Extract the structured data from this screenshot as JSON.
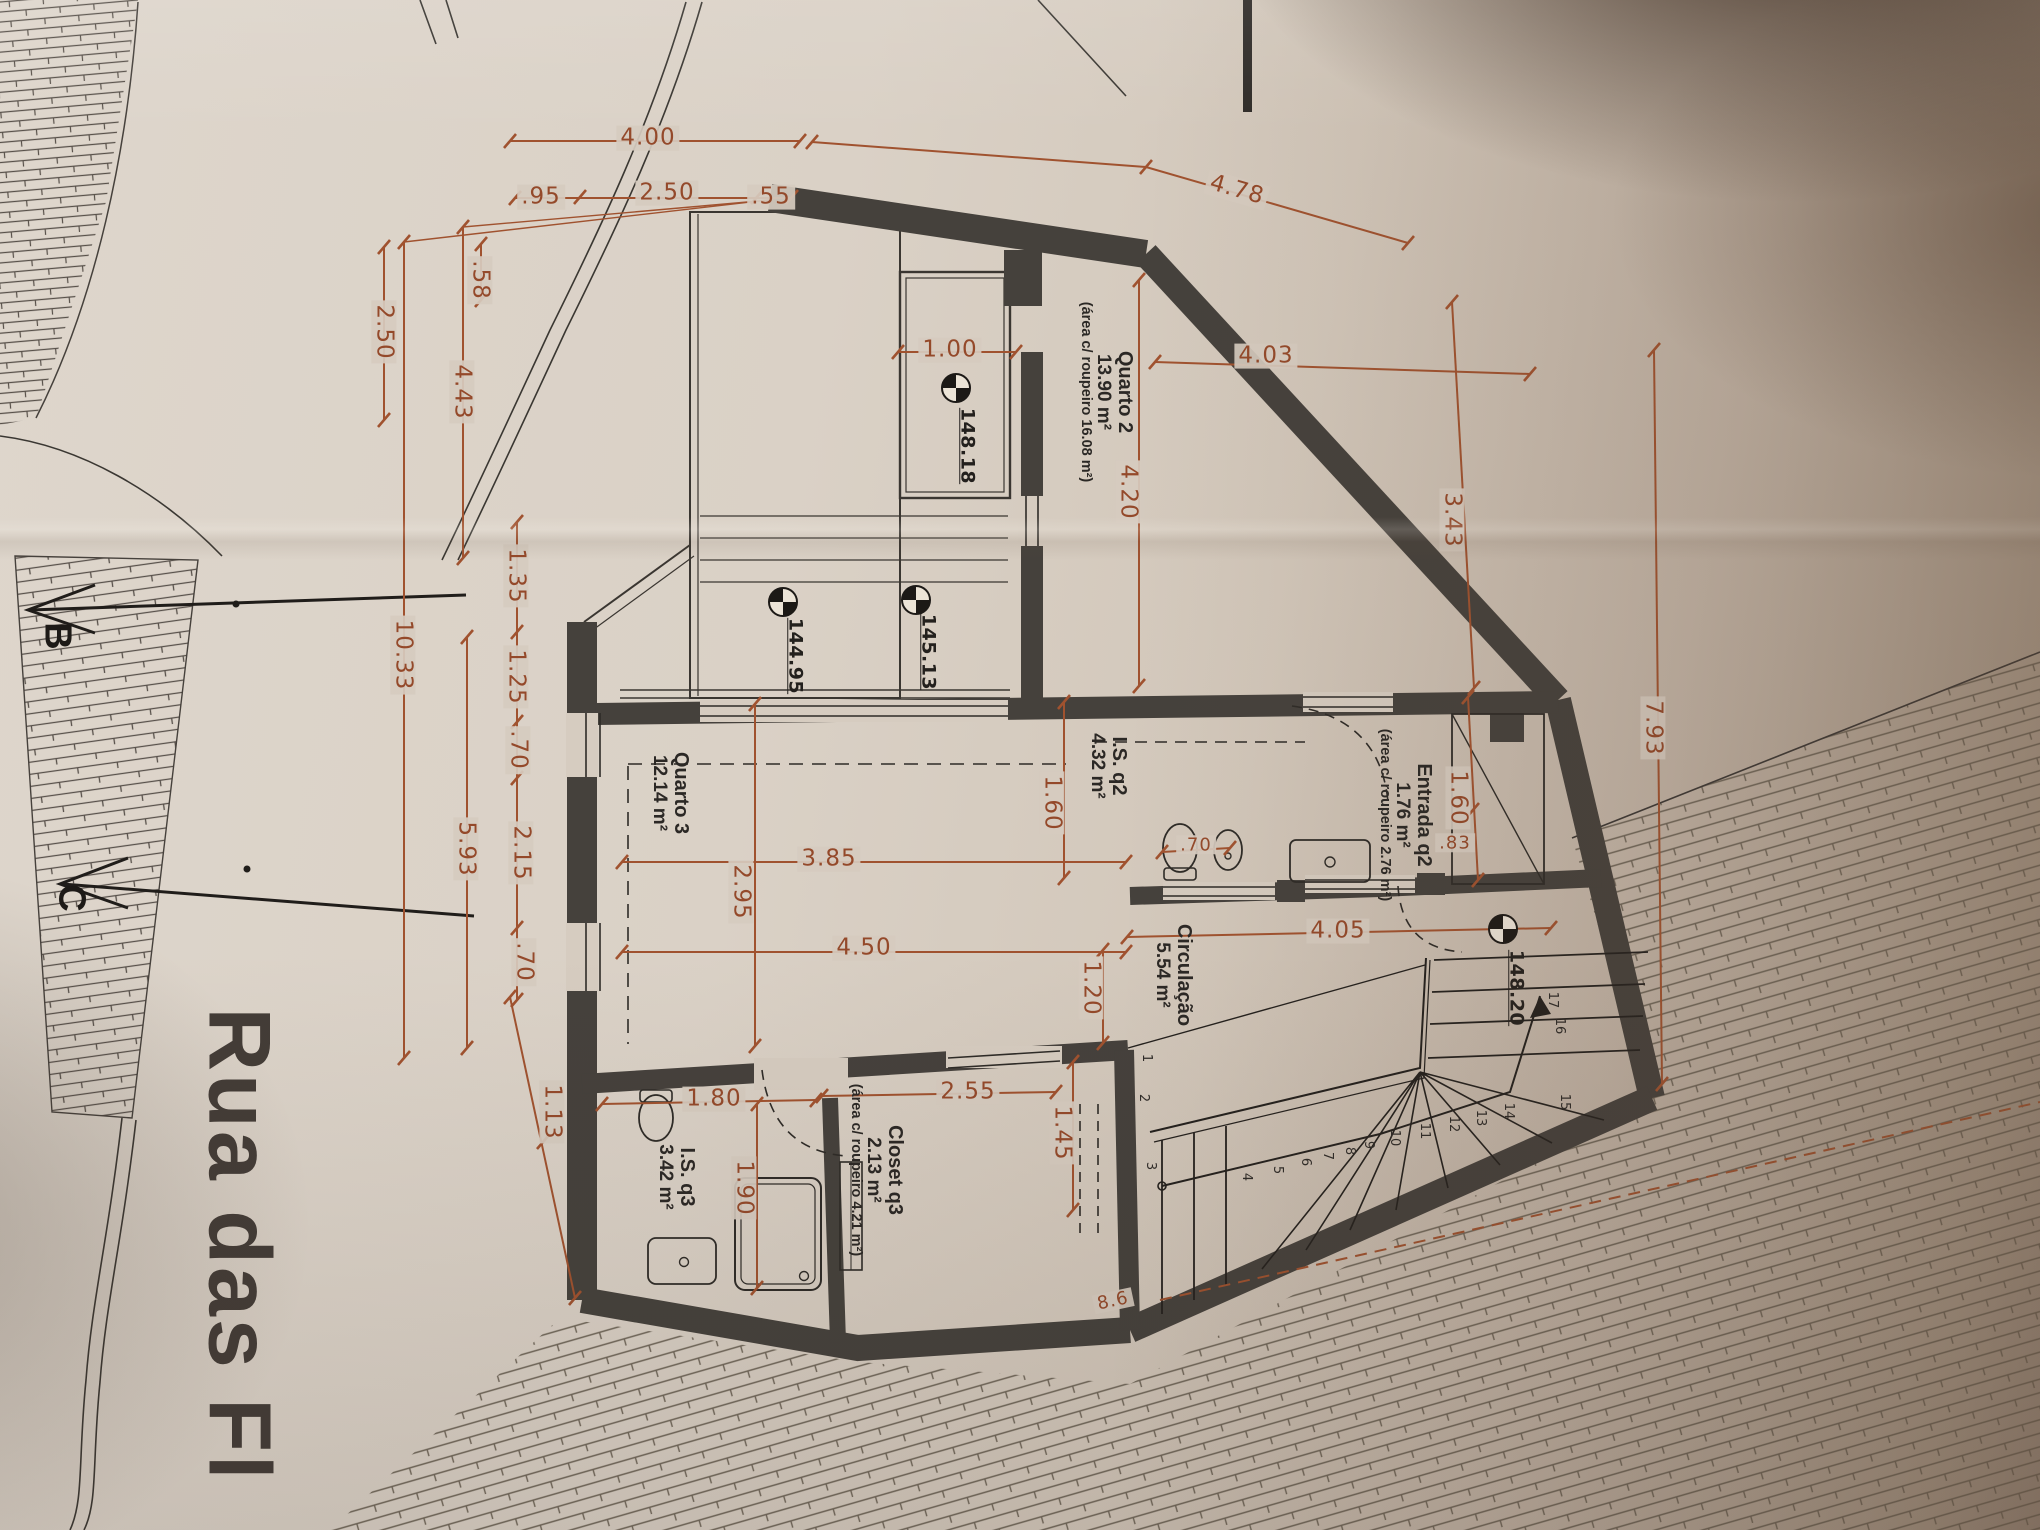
{
  "document": {
    "kind": "Architectural floor plan (photographed drawing)",
    "language": "Portuguese"
  },
  "colors": {
    "paper": "#d8cec3",
    "wall": "#45413c",
    "ink": "#2a2825",
    "dimension_red": "#94492a"
  },
  "street": {
    "label": "Rua das Fl",
    "x": 240,
    "y": 1245
  },
  "sections": [
    {
      "label": "B",
      "x": 57,
      "y": 636
    },
    {
      "label": "C",
      "x": 71,
      "y": 898
    }
  ],
  "rooms": [
    {
      "id": "quarto-2",
      "name": "Quarto 2",
      "area": "13.90 m²",
      "note": "(área c/ roupeiro 16.08 m²)",
      "x": 1106,
      "y": 392
    },
    {
      "id": "entrada-q2",
      "name": "Entrada q2",
      "area": "1.76 m²",
      "note": "(área c/ roupeiro 2.76 m²)",
      "x": 1405,
      "y": 815
    },
    {
      "id": "is-q2",
      "name": "I.S. q2",
      "area": "4.32 m²",
      "note": "",
      "x": 1108,
      "y": 766
    },
    {
      "id": "circulacao",
      "name": "Circulação",
      "area": "5.54 m²",
      "note": "",
      "x": 1173,
      "y": 975
    },
    {
      "id": "quarto-3",
      "name": "Quarto 3",
      "area": "12.14 m²",
      "note": "",
      "x": 670,
      "y": 793
    },
    {
      "id": "closet-q3",
      "name": "Closet q3",
      "area": "2.13 m²",
      "note": "(área c/ roupeiro 4.21 m²)",
      "x": 876,
      "y": 1170
    },
    {
      "id": "is-q3",
      "name": "I.S. q3",
      "area": "3.42 m²",
      "note": "",
      "x": 676,
      "y": 1177
    }
  ],
  "levels": [
    {
      "value": "148.18",
      "cx": 956,
      "cy": 388,
      "lx": 967,
      "ly": 446
    },
    {
      "value": "145.13",
      "cx": 916,
      "cy": 600,
      "lx": 928,
      "ly": 652
    },
    {
      "value": "144.95",
      "cx": 783,
      "cy": 602,
      "lx": 795,
      "ly": 656
    },
    {
      "value": "148.20",
      "cx": 1503,
      "cy": 929,
      "lx": 1516,
      "ly": 988
    }
  ],
  "dimensions": [
    {
      "text": "4.00",
      "x": 648,
      "y": 138,
      "rot": 0
    },
    {
      "text": ".95",
      "x": 541,
      "y": 197,
      "rot": 0
    },
    {
      "text": "2.50",
      "x": 667,
      "y": 193,
      "rot": 0
    },
    {
      "text": ".55",
      "x": 771,
      "y": 197,
      "rot": 0
    },
    {
      "text": "4.78",
      "x": 1237,
      "y": 190,
      "rot": 16
    },
    {
      "text": ".58",
      "x": 480,
      "y": 280,
      "rot": 90
    },
    {
      "text": "2.50",
      "x": 384,
      "y": 332,
      "rot": 90
    },
    {
      "text": "4.43",
      "x": 462,
      "y": 392,
      "rot": 90
    },
    {
      "text": "10.33",
      "x": 403,
      "y": 655,
      "rot": 90
    },
    {
      "text": "1.35",
      "x": 516,
      "y": 576,
      "rot": 90
    },
    {
      "text": "1.25",
      "x": 516,
      "y": 677,
      "rot": 90
    },
    {
      "text": ".70",
      "x": 518,
      "y": 750,
      "rot": 90
    },
    {
      "text": "2.15",
      "x": 521,
      "y": 853,
      "rot": 90
    },
    {
      "text": "5.93",
      "x": 466,
      "y": 849,
      "rot": 90
    },
    {
      "text": ".70",
      "x": 524,
      "y": 962,
      "rot": 90
    },
    {
      "text": "1.13",
      "x": 552,
      "y": 1112,
      "rot": 90
    },
    {
      "text": "1.00",
      "x": 950,
      "y": 350,
      "rot": 0
    },
    {
      "text": "4.03",
      "x": 1266,
      "y": 356,
      "rot": 0
    },
    {
      "text": "4.20",
      "x": 1128,
      "y": 492,
      "rot": 90
    },
    {
      "text": "3.43",
      "x": 1452,
      "y": 520,
      "rot": 90
    },
    {
      "text": "1.60",
      "x": 1458,
      "y": 798,
      "rot": 90
    },
    {
      "text": ".83",
      "x": 1455,
      "y": 843,
      "rot": 0,
      "small": true
    },
    {
      "text": "1.60",
      "x": 1052,
      "y": 803,
      "rot": 90
    },
    {
      "text": ".70",
      "x": 1196,
      "y": 845,
      "rot": 0,
      "small": true
    },
    {
      "text": "3.85",
      "x": 829,
      "y": 859,
      "rot": 0
    },
    {
      "text": "2.95",
      "x": 741,
      "y": 892,
      "rot": 90
    },
    {
      "text": "4.50",
      "x": 864,
      "y": 948,
      "rot": 0
    },
    {
      "text": "1.20",
      "x": 1091,
      "y": 988,
      "rot": 90
    },
    {
      "text": "4.05",
      "x": 1338,
      "y": 931,
      "rot": 0
    },
    {
      "text": "2.55",
      "x": 968,
      "y": 1092,
      "rot": 0
    },
    {
      "text": "1.45",
      "x": 1062,
      "y": 1133,
      "rot": 90
    },
    {
      "text": "1.80",
      "x": 714,
      "y": 1099,
      "rot": 0
    },
    {
      "text": "1.90",
      "x": 744,
      "y": 1188,
      "rot": 90
    },
    {
      "text": "7.93",
      "x": 1653,
      "y": 728,
      "rot": 90
    },
    {
      "text": "8.6",
      "x": 1113,
      "y": 1301,
      "rot": -12,
      "small": true
    }
  ],
  "stairs": {
    "numbers": [
      {
        "n": "1",
        "x": 1146,
        "y": 1058
      },
      {
        "n": "2",
        "x": 1143,
        "y": 1098
      },
      {
        "n": "3",
        "x": 1150,
        "y": 1166
      },
      {
        "n": "4",
        "x": 1246,
        "y": 1177
      },
      {
        "n": "5",
        "x": 1277,
        "y": 1170
      },
      {
        "n": "6",
        "x": 1305,
        "y": 1162
      },
      {
        "n": "7",
        "x": 1327,
        "y": 1156
      },
      {
        "n": "8",
        "x": 1349,
        "y": 1151
      },
      {
        "n": "9",
        "x": 1368,
        "y": 1145
      },
      {
        "n": "10",
        "x": 1394,
        "y": 1138
      },
      {
        "n": "11",
        "x": 1424,
        "y": 1131
      },
      {
        "n": "12",
        "x": 1453,
        "y": 1124
      },
      {
        "n": "13",
        "x": 1480,
        "y": 1118
      },
      {
        "n": "14",
        "x": 1508,
        "y": 1111
      },
      {
        "n": "15",
        "x": 1564,
        "y": 1102
      },
      {
        "n": "16",
        "x": 1559,
        "y": 1026
      },
      {
        "n": "17",
        "x": 1552,
        "y": 1000
      }
    ]
  }
}
